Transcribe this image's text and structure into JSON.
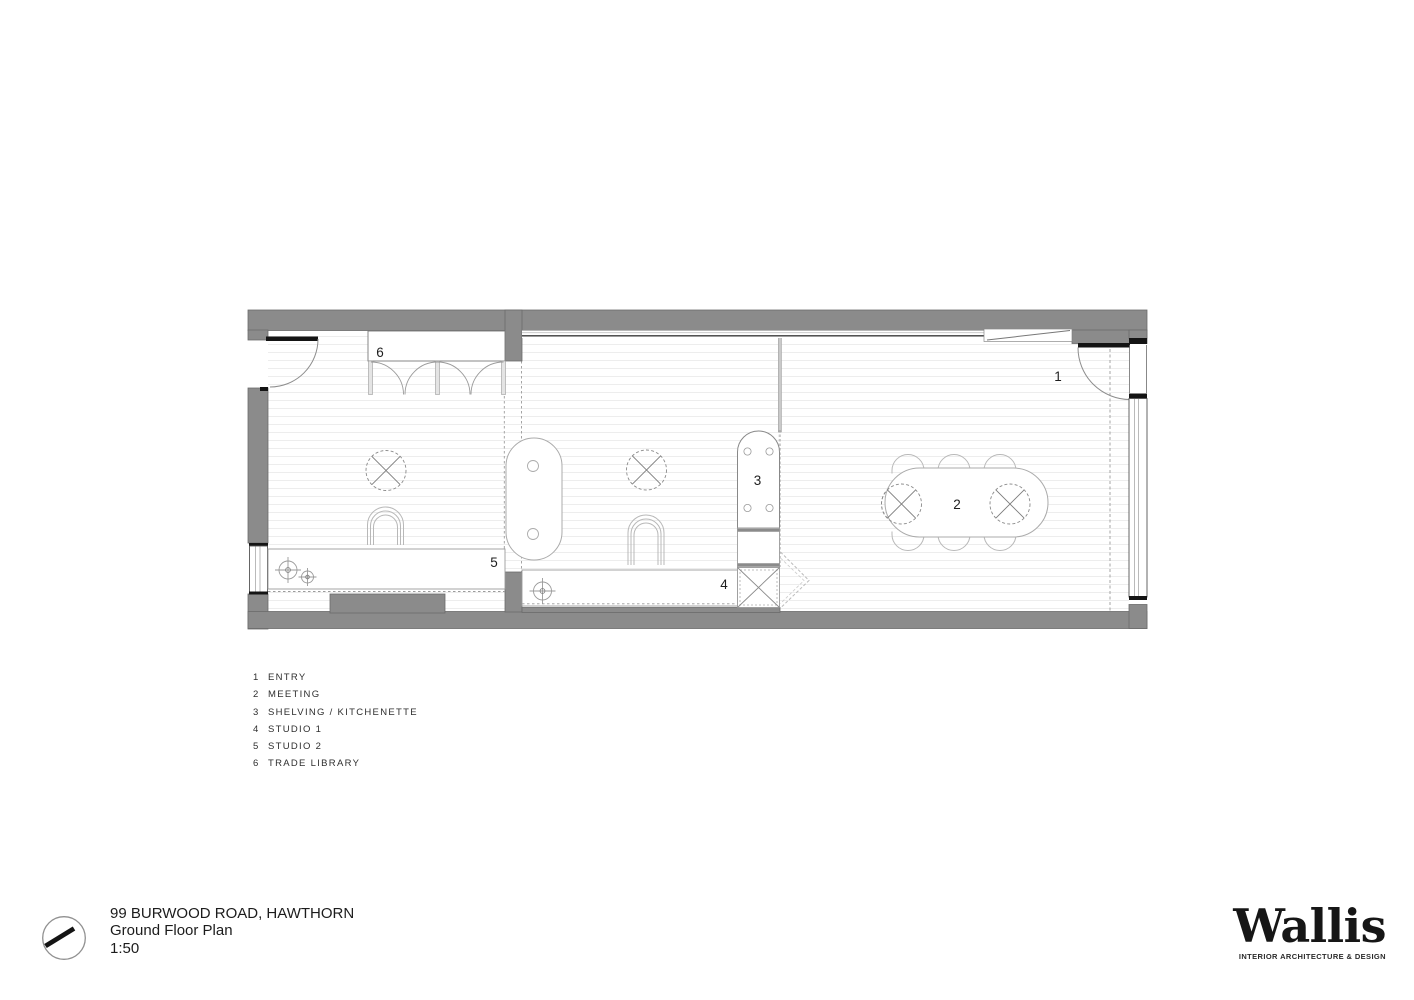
{
  "plan": {
    "markers": {
      "m1": "1",
      "m2": "2",
      "m3": "3",
      "m4": "4",
      "m5": "5",
      "m6": "6"
    }
  },
  "legend": {
    "items": [
      {
        "number": "1",
        "label": "ENTRY"
      },
      {
        "number": "2",
        "label": "MEETING"
      },
      {
        "number": "3",
        "label": "SHELVING / KITCHENETTE"
      },
      {
        "number": "4",
        "label": "STUDIO 1"
      },
      {
        "number": "5",
        "label": "STUDIO 2"
      },
      {
        "number": "6",
        "label": "TRADE LIBRARY"
      }
    ]
  },
  "title_block": {
    "address": "99 BURWOOD ROAD, HAWTHORN",
    "drawing_name": "Ground Floor Plan",
    "scale": "1:50"
  },
  "logo": {
    "wordmark": "Wallis",
    "tagline": "INTERIOR ARCHITECTURE & DESIGN"
  },
  "colors": {
    "wall_gray": "#8b8b8b",
    "line_black": "#141414",
    "line_mid": "#999999",
    "floor_line": "#ededed"
  }
}
